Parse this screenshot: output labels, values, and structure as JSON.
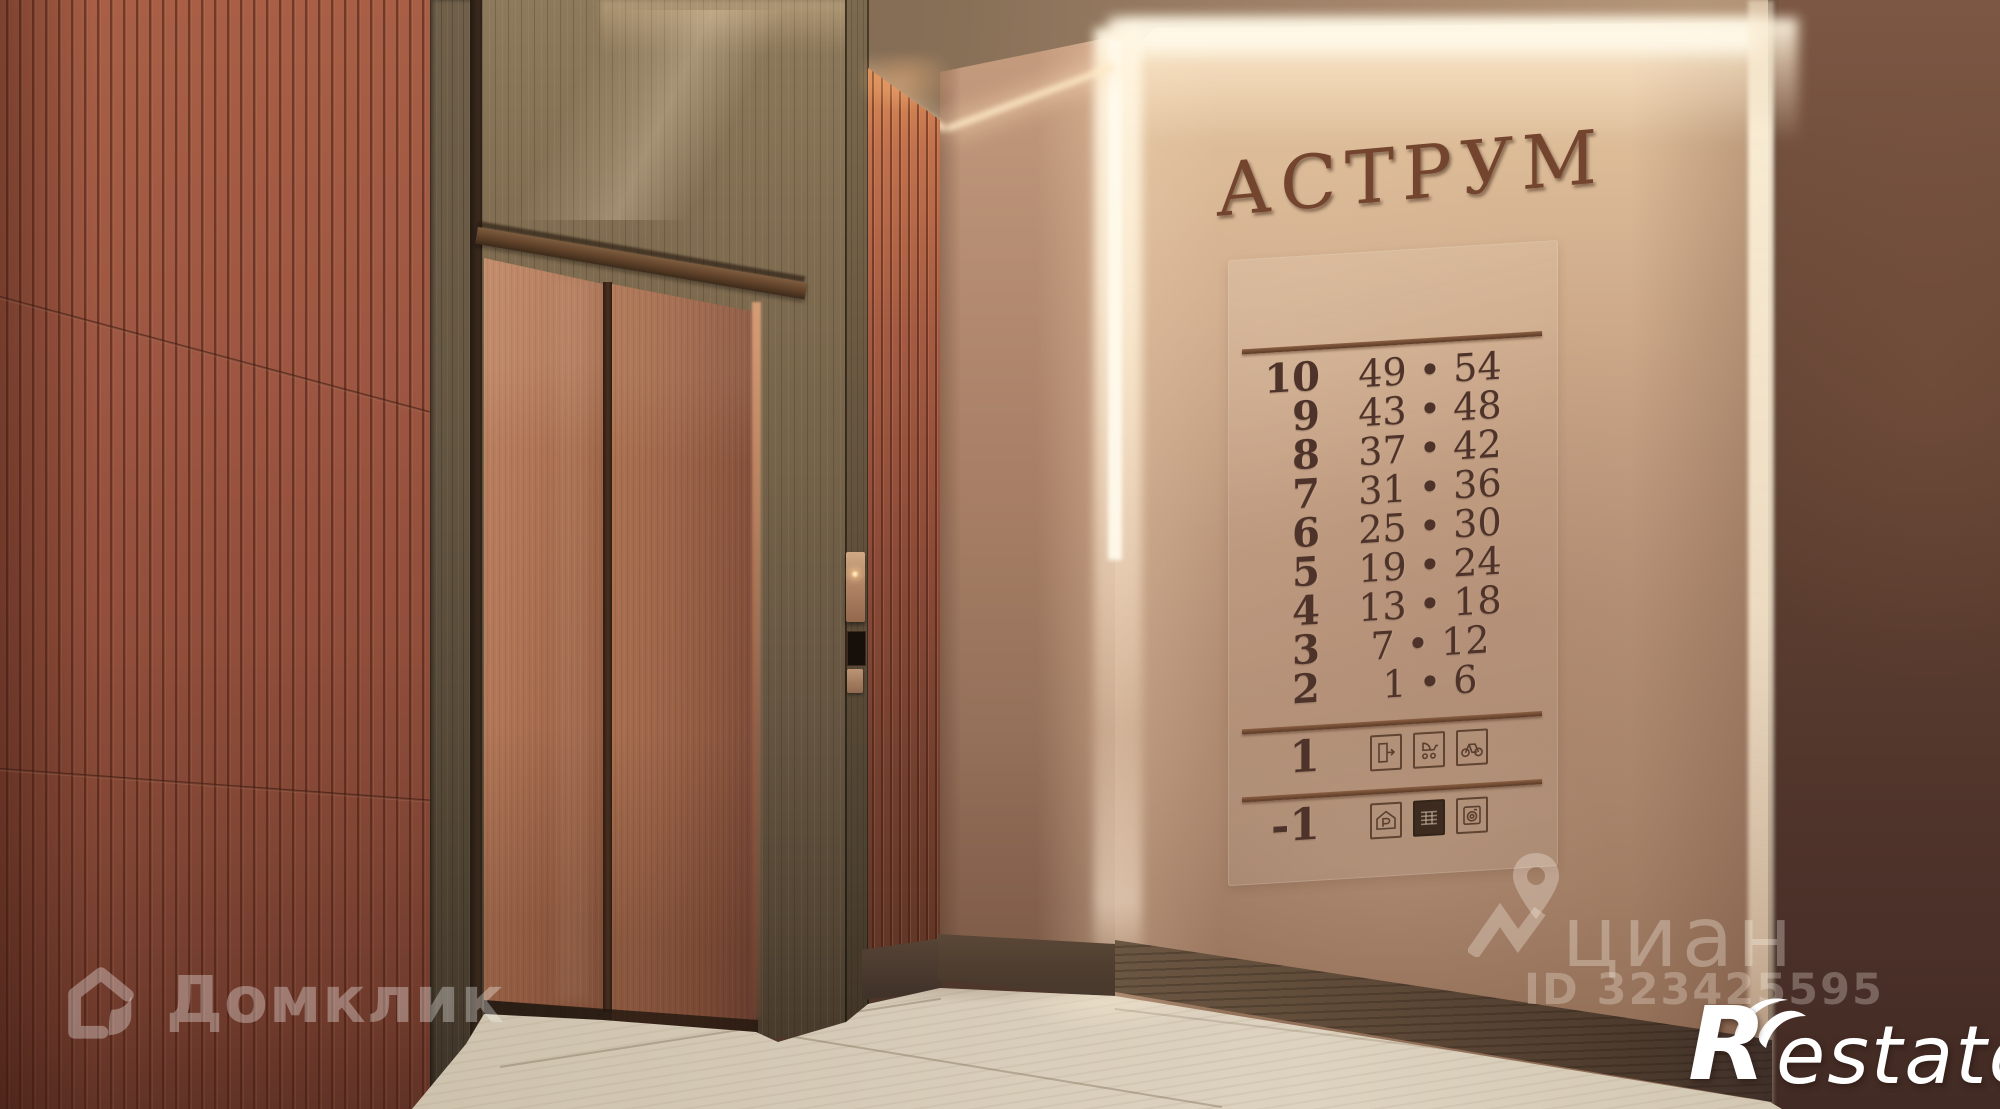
{
  "scene": {
    "sign": {
      "building_name": "АСТРУМ"
    },
    "directory": {
      "floors": [
        {
          "floor": "10",
          "range": "49 • 54"
        },
        {
          "floor": "9",
          "range": "43 • 48"
        },
        {
          "floor": "8",
          "range": "37 • 42"
        },
        {
          "floor": "7",
          "range": "31 • 36"
        },
        {
          "floor": "6",
          "range": "25 • 30"
        },
        {
          "floor": "5",
          "range": "19 • 24"
        },
        {
          "floor": "4",
          "range": "13 • 18"
        },
        {
          "floor": "3",
          "range": "7 • 12"
        },
        {
          "floor": "2",
          "range": "1 • 6"
        }
      ],
      "amenities": [
        {
          "floor": "1",
          "icons": [
            "exit-icon",
            "stroller-icon",
            "bicycle-icon"
          ]
        },
        {
          "floor": "-1",
          "icons": [
            "parking-icon",
            "storage-icon",
            "washer-icon"
          ]
        }
      ]
    }
  },
  "watermarks": {
    "domclick": {
      "label": "Домклик"
    },
    "cian": {
      "label": "циан",
      "listing_id": "ID 323425595"
    },
    "restate": {
      "initial": "R",
      "rest": "estate"
    }
  },
  "colors": {
    "terracotta_panel": "#9a5540",
    "copper_door": "#a86e50",
    "wood_frame": "#6f5d46",
    "plaster_wall": "#c7a385",
    "bronze_letters": "#74452e",
    "cove_light": "#ffe9c4",
    "floor_tile": "#d6cbb8"
  }
}
